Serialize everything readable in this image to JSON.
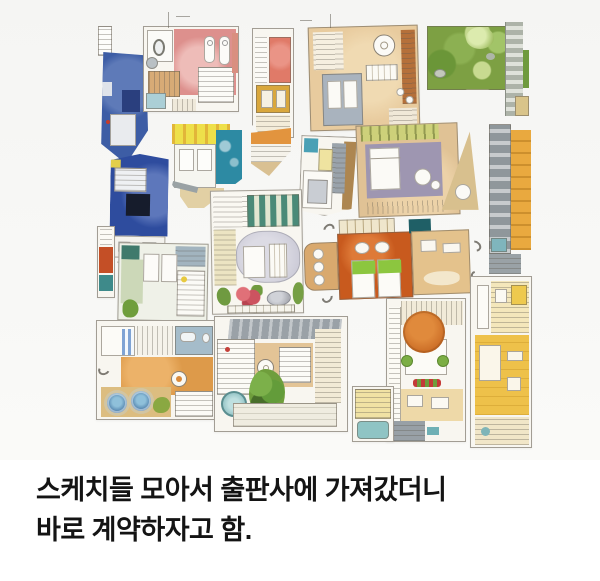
{
  "caption": {
    "line1": "스케치들 모아서 출판사에 가져갔더니",
    "line2": "바로 계약하자고 함."
  },
  "collage": {
    "kind": "collage of hand-drawn watercolor architectural floor plan sketches on light background",
    "items": [
      {
        "name": "blue-tower-plan",
        "palette": [
          "#3d5da5",
          "#2a3f7e",
          "#e9ebee"
        ]
      },
      {
        "name": "pink-suite-plan",
        "palette": [
          "#dd908d",
          "#d7ab76",
          "#abcfd6"
        ]
      },
      {
        "name": "coral-amber-strip-plan",
        "palette": [
          "#e07a68",
          "#d9a73c"
        ]
      },
      {
        "name": "tan-studio-plan",
        "palette": [
          "#e8cb9e",
          "#b5703a",
          "#a9b3be"
        ]
      },
      {
        "name": "garden-landscape-plan",
        "palette": [
          "#7da043",
          "#c4d88e",
          "#d8dcd2"
        ]
      },
      {
        "name": "navy-unit-plan",
        "palette": [
          "#2e4c9e",
          "#161c2c",
          "#5d77bb"
        ]
      },
      {
        "name": "yellow-teal-plan",
        "palette": [
          "#eee04a",
          "#2d8aa3"
        ]
      },
      {
        "name": "orange-wedge-plan",
        "palette": [
          "#e2943e",
          "#d9c092"
        ]
      },
      {
        "name": "gray-suite-plan",
        "palette": [
          "#9aa3ab",
          "#ad8650",
          "#4aa0b5"
        ]
      },
      {
        "name": "green-courtyard-plan",
        "palette": [
          "#a9b87c",
          "#cdccd8",
          "#cc5360"
        ]
      },
      {
        "name": "sage-suite-plan",
        "palette": [
          "#ccd8b8",
          "#3f7a6c",
          "#a2b4bf"
        ]
      },
      {
        "name": "red-teal-strip-plan",
        "palette": [
          "#c44f26",
          "#3e8a8a"
        ]
      },
      {
        "name": "mauve-suite-plan",
        "palette": [
          "#e0c295",
          "#9e96b1",
          "#cdd17a"
        ]
      },
      {
        "name": "amber-gray-strip-plan",
        "palette": [
          "#8f979b",
          "#e9a93f"
        ]
      },
      {
        "name": "orange-twinbed-plan",
        "palette": [
          "#c85a1e",
          "#8cc63f",
          "#d9a96e"
        ]
      },
      {
        "name": "terrace-hottub-plan",
        "palette": [
          "#dd9a4a",
          "#a5bcca",
          "#4a7ea8"
        ]
      },
      {
        "name": "tree-courtyard-plan",
        "palette": [
          "#e3c496",
          "#639c3a",
          "#8fc0c2"
        ]
      },
      {
        "name": "orange-tree-plan",
        "palette": [
          "#c96a24",
          "#eed9a8",
          "#7cae44"
        ]
      },
      {
        "name": "pool-annex-plan",
        "palette": [
          "#f0e2a4",
          "#8fc4c4"
        ]
      },
      {
        "name": "gold-tower-plan",
        "palette": [
          "#eec14a",
          "#f4e7bb"
        ]
      }
    ]
  },
  "colors": {
    "canvas": "#f5f5f3",
    "caption_bg": "#ffffff",
    "caption_text": "#141414"
  }
}
